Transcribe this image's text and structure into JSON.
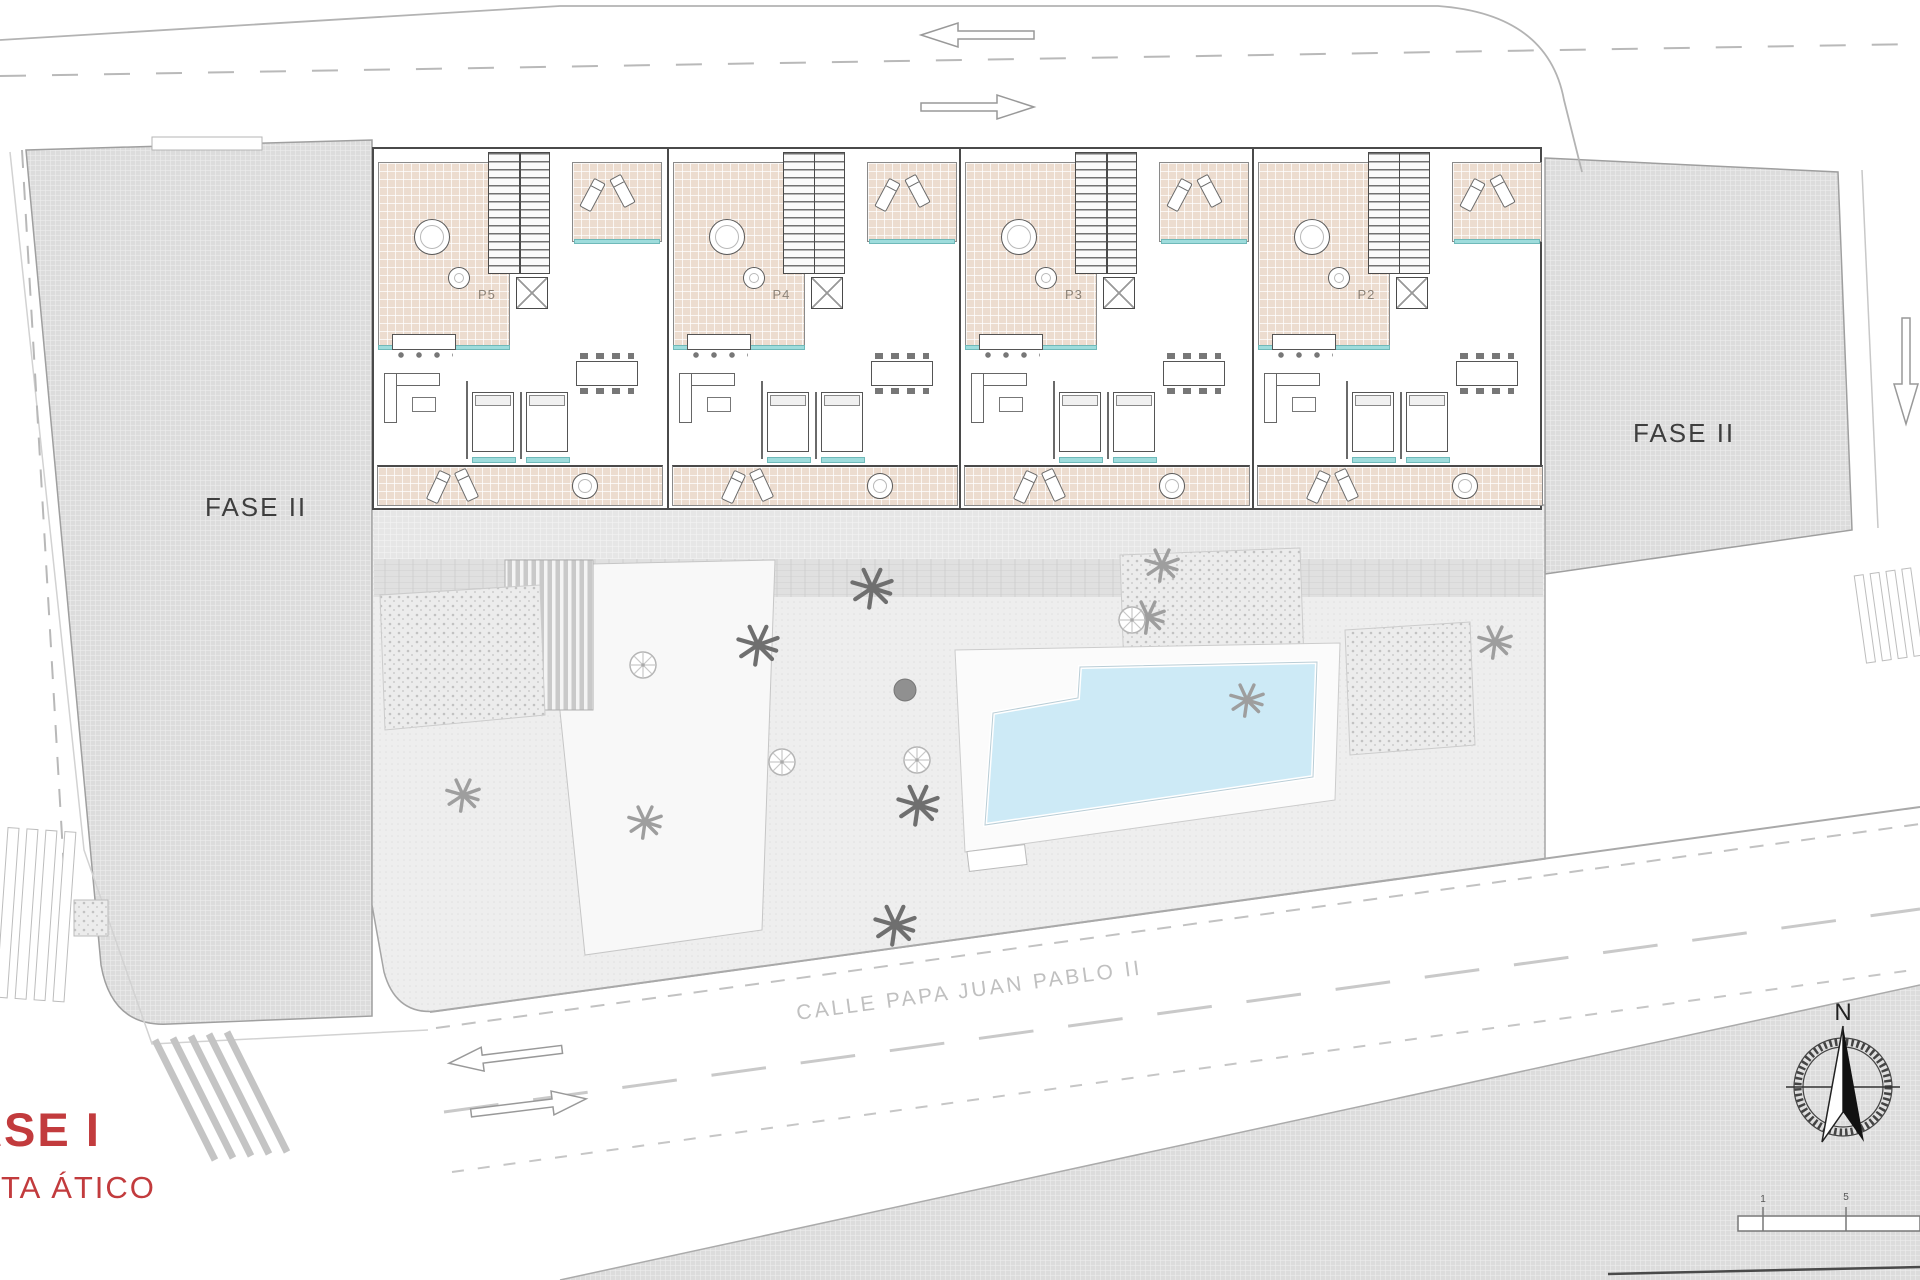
{
  "plan_labels": {
    "phase1": "FASE I",
    "floor": "PLANTA ÁTICO",
    "phase2_left": "FASE II",
    "phase2_right": "FASE II"
  },
  "street": {
    "name": "CALLE PAPA JUAN PABLO II"
  },
  "units": [
    {
      "label": "P5"
    },
    {
      "label": "P4"
    },
    {
      "label": "P3"
    },
    {
      "label": "P2"
    }
  ],
  "compass": {
    "north_label": "N"
  },
  "scale_bar": {
    "tick_labels": [
      "1",
      "5"
    ]
  },
  "colors": {
    "phase_text_red": "#c23b3d",
    "pool_water": "#cdeaf6",
    "terrace_tile": "#ecdccf",
    "teal_accent": "#9edcdc",
    "block_gray": "#dcdcdc"
  }
}
